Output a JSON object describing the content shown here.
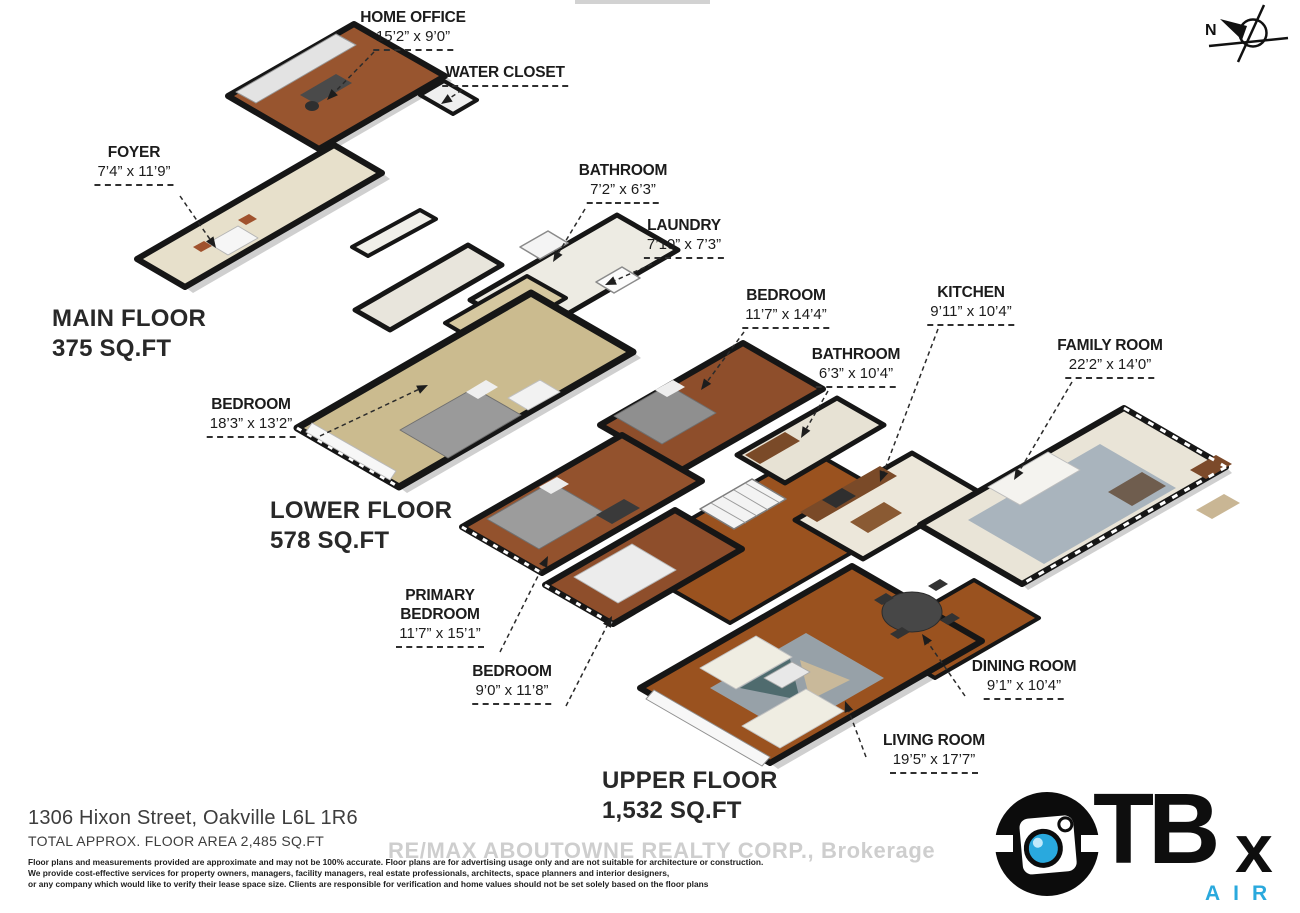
{
  "compass": {
    "label": "N"
  },
  "floor_titles": {
    "main": {
      "title": "MAIN FLOOR",
      "area": "375 SQ.FT"
    },
    "lower": {
      "title": "LOWER FLOOR",
      "area": "578 SQ.FT"
    },
    "upper": {
      "title": "UPPER FLOOR",
      "area": "1,532 SQ.FT"
    }
  },
  "rooms": [
    {
      "id": "home-office",
      "floor": "main",
      "name": "HOME OFFICE",
      "dims": "15’2” x 9’0”"
    },
    {
      "id": "water-closet",
      "floor": "main",
      "name": "WATER CLOSET",
      "dims": ""
    },
    {
      "id": "foyer",
      "floor": "main",
      "name": "FOYER",
      "dims": "7’4” x 11’9”"
    },
    {
      "id": "bathroom-lower",
      "floor": "lower",
      "name": "BATHROOM",
      "dims": "7’2” x 6’3”"
    },
    {
      "id": "laundry",
      "floor": "lower",
      "name": "LAUNDRY",
      "dims": "7’10” x 7’3”"
    },
    {
      "id": "bedroom-lower",
      "floor": "lower",
      "name": "BEDROOM",
      "dims": "18’3” x 13’2”"
    },
    {
      "id": "bedroom-upper",
      "floor": "upper",
      "name": "BEDROOM",
      "dims": "11’7” x 14’4”"
    },
    {
      "id": "kitchen",
      "floor": "upper",
      "name": "KITCHEN",
      "dims": "9’11” x 10’4”"
    },
    {
      "id": "bathroom-upper",
      "floor": "upper",
      "name": "BATHROOM",
      "dims": "6’3” x 10’4”"
    },
    {
      "id": "family-room",
      "floor": "upper",
      "name": "FAMILY ROOM",
      "dims": "22’2” x 14’0”"
    },
    {
      "id": "primary-bedroom",
      "floor": "upper",
      "name": "PRIMARY BEDROOM",
      "dims": "11’7” x 15’1”"
    },
    {
      "id": "bedroom-2",
      "floor": "upper",
      "name": "BEDROOM",
      "dims": "9’0” x 11’8”"
    },
    {
      "id": "dining-room",
      "floor": "upper",
      "name": "DINING ROOM",
      "dims": "9’1” x 10’4”"
    },
    {
      "id": "living-room",
      "floor": "upper",
      "name": "LIVING ROOM",
      "dims": "19’5” x 17’7”"
    }
  ],
  "footer": {
    "address": "1306 Hixon Street, Oakville L6L 1R6",
    "total": "TOTAL APPROX. FLOOR AREA 2,485 SQ.FT",
    "disclaimer": [
      "Floor plans and measurements provided are approximate and may not be 100% accurate. Floor plans are for advertising usage only and are not suitable for architecture or construction.",
      "We provide cost-effective services for property owners, managers, facility managers, real estate professionals, architects, space planners and interior designers,",
      "or any company which would like to verify their lease space size. Clients are responsible for verification and home values should not be set solely based on the floor plans"
    ]
  },
  "watermark": "RE/MAX ABOUTOWNE REALTY CORP., Brokerage",
  "logo": {
    "brand_t": "TB",
    "brand_x": "x",
    "sub": "AIR",
    "accent": "#2aa9dd"
  },
  "colors": {
    "walls": "#161616",
    "wood": "#9a521f",
    "wood_dark": "#8e4e2b",
    "carpet_tan": "#cbbb8f",
    "tile": "#e9e4d7",
    "rug_blue": "#a9b4bd",
    "accent_blue": "#2aa9dd"
  }
}
